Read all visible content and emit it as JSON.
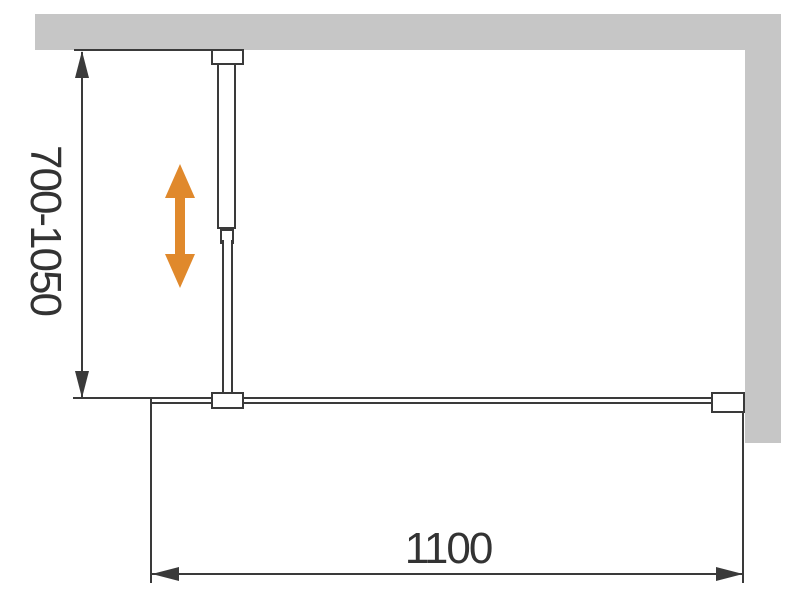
{
  "colors": {
    "wall": "#c6c6c6",
    "line": "#3a3a3a",
    "accent": "#e0892c",
    "background": "#ffffff"
  },
  "diagram": {
    "type": "technical-drawing",
    "vertical_dimension": {
      "label": "700-1050",
      "min": 700,
      "max": 1050
    },
    "horizontal_dimension": {
      "label": "1100",
      "value": 1100
    },
    "icons": {
      "adjust_arrow": "double-vertical-arrow"
    }
  }
}
